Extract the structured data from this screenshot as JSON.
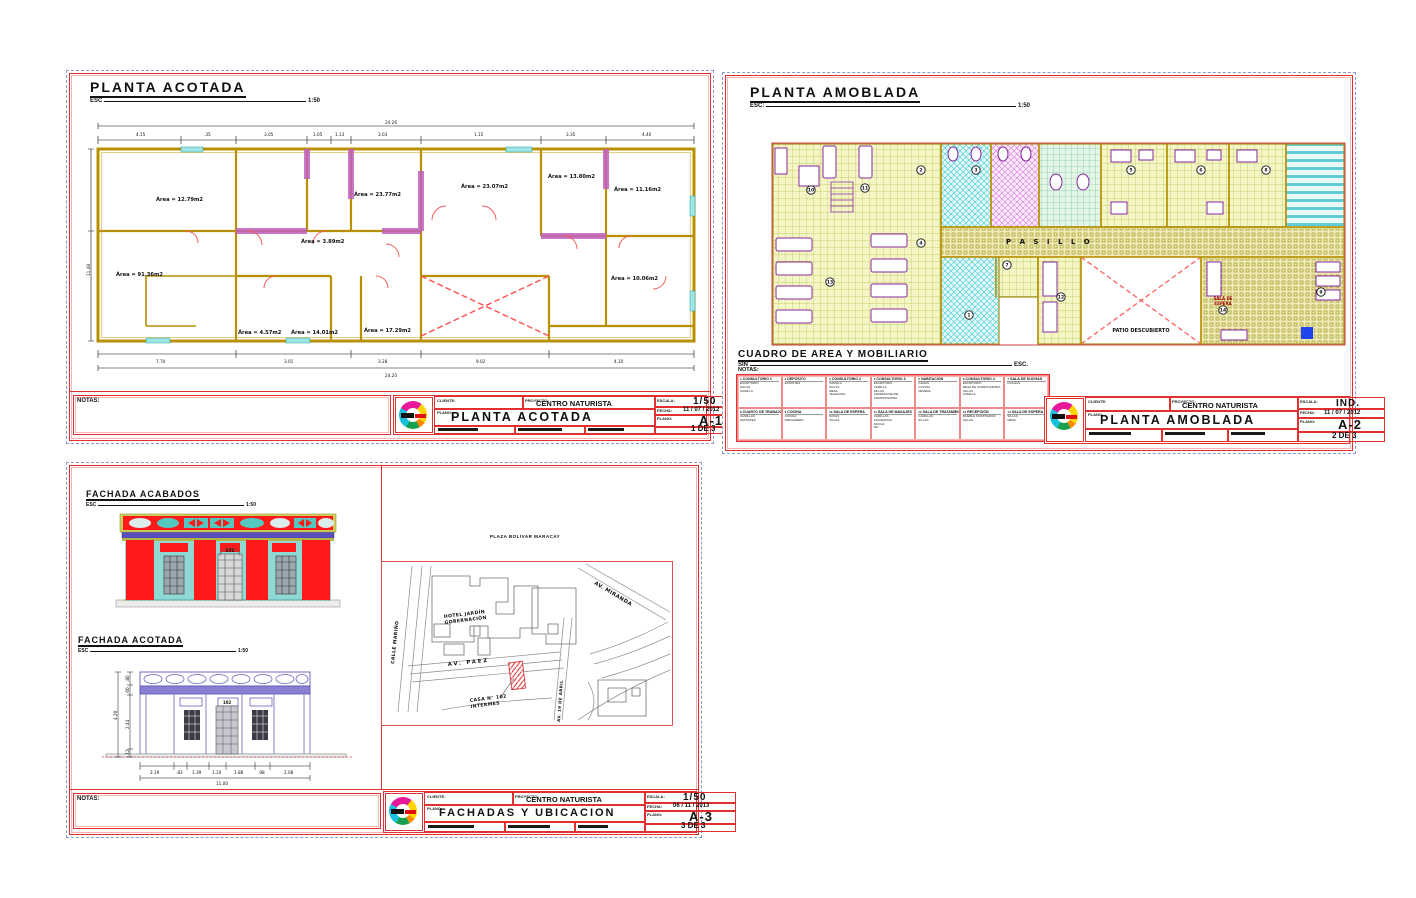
{
  "colors": {
    "sheet_border": "#e03030",
    "pink": "#ffb4b4",
    "dash": "#8d97c9",
    "wall": "#b89000",
    "door": "#f06060",
    "patio_x": "#ff5050",
    "window": "#9fe5e5",
    "hatch_wall": "#c060c0",
    "facade_red": "#ff0000",
    "facade_teal": "#8fd8d4",
    "facade_purple": "#5a4fc0",
    "facade_olive": "#b4b448"
  },
  "sheet1": {
    "title": "PLANTA ACOTADA",
    "esc_label": "ESC",
    "esc_value": "1:50",
    "notas_label": "NOTAS:",
    "areas": [
      "Área = 12.79m2",
      "Área = 23.77m2",
      "Área = 23.07m2",
      "Área = 13.80m2",
      "Área = 11.16m2",
      "Área = 91.36m2",
      "Área = 3.89m2",
      "Área = 4.57m2",
      "Área = 14.01m2",
      "Área = 17.29m2",
      "Área = 10.06m2"
    ],
    "dim_top_total": "24.26",
    "dims_top": [
      "4.15",
      ".35",
      "3.05",
      "1.05",
      "1.13",
      "3.03",
      "1.15",
      "3.35",
      "4.40"
    ],
    "dims_bottom": [
      "7.70",
      "3.01",
      "3.28",
      "9.02",
      "4.10"
    ],
    "dim_bottom_total": "24.20",
    "dim_left_total": "11.48",
    "titleblock": {
      "cliente_label": "CLIENTE:",
      "proyecto_label": "PROYECTO:",
      "proyecto": "CENTRO NATURISTA",
      "plano_label": "PLANO:",
      "plano": "PLANTA ACOTADA",
      "escala_label": "ESCALA:",
      "escala": "1/50",
      "fecha_label": "FECHA:",
      "fecha": "11 / 07 / 2012",
      "codigo_label": "PLANO:",
      "codigo": "A-1",
      "lamina_label": "LAMINA:",
      "lamina": "1 DE 3"
    }
  },
  "sheet2": {
    "title": "PLANTA AMOBLADA",
    "esc_label": "ESC:",
    "esc_value": "1:50",
    "pasillo": "P A S I L L O",
    "patio": "PATIO DESCUBIERTO",
    "sala_line1": "SALA DE",
    "sala_line2": "ESPERA",
    "room_numbers": [
      {
        "n": "1",
        "x": 198,
        "y": 173
      },
      {
        "n": "2",
        "x": 150,
        "y": 28
      },
      {
        "n": "3",
        "x": 205,
        "y": 28
      },
      {
        "n": "4",
        "x": 150,
        "y": 101
      },
      {
        "n": "5",
        "x": 360,
        "y": 28
      },
      {
        "n": "6",
        "x": 430,
        "y": 28
      },
      {
        "n": "7",
        "x": 236,
        "y": 123
      },
      {
        "n": "8",
        "x": 495,
        "y": 28
      },
      {
        "n": "9",
        "x": 550,
        "y": 150
      },
      {
        "n": "10",
        "x": 40,
        "y": 48
      },
      {
        "n": "11",
        "x": 94,
        "y": 46
      },
      {
        "n": "12",
        "x": 290,
        "y": 155
      },
      {
        "n": "13",
        "x": 59,
        "y": 140
      },
      {
        "n": "14",
        "x": 452,
        "y": 168
      }
    ],
    "cuadro": {
      "title": "CUADRO DE AREA Y MOBILIARIO",
      "sin_label": "SIN",
      "esc_label": "ESC.",
      "notas_label": "NOTAS:",
      "cells": [
        {
          "num": "1",
          "name": "CONSULTORIO 1",
          "items": [
            "ESCRITORIO",
            "SILLAS",
            "CAMILLA"
          ]
        },
        {
          "num": "2",
          "name": "DEPOSITO",
          "items": [
            "ESTANTES"
          ]
        },
        {
          "num": "3",
          "name": "CONSULTORIO 2",
          "items": [
            "CAMILLA",
            "SILLAS",
            "MESA",
            "TELEFONO"
          ]
        },
        {
          "num": "4",
          "name": "CONSULTORIO 3",
          "items": [
            "ESCRITORIO",
            "CAMILLA",
            "SILLAS",
            "LAMPARA DE PIE",
            "COMPUTADORA"
          ]
        },
        {
          "num": "5",
          "name": "HABITACIÓN",
          "items": [
            "CAMAS",
            "COCINA",
            "NEVERA"
          ]
        },
        {
          "num": "6",
          "name": "CONSULTORIO 4",
          "items": [
            "ESCRITORIO",
            "MESA DE COMPUTADORA",
            "SILLAS",
            "CAMILLA"
          ]
        },
        {
          "num": "7",
          "name": "SALA DE DUCHAS",
          "items": [
            "DUCHAS"
          ]
        },
        {
          "num": "8",
          "name": "CUARTO DE TRABAJO",
          "items": [
            "CAMILLAS",
            "ESTANTES"
          ]
        },
        {
          "num": "9",
          "name": "COCINA",
          "items": [
            "COCINA",
            "FREGADERO"
          ]
        },
        {
          "num": "10",
          "name": "SALA DE ESPERA",
          "items": [
            "SOFAS",
            "SILLAS"
          ]
        },
        {
          "num": "11",
          "name": "SALA DE MASAJES",
          "items": [
            "CAMILLAS",
            "LAVAMANOS",
            "DUCHA",
            "WC"
          ]
        },
        {
          "num": "12",
          "name": "SALA DE TRATAMIENTO",
          "items": [
            "CAMILLAS",
            "SILLAS"
          ]
        },
        {
          "num": "13",
          "name": "RECEPCIÓN",
          "items": [
            "MUEBLE MOSTRADOR",
            "SILLAS"
          ]
        },
        {
          "num": "14",
          "name": "SALA DE ESPERA",
          "items": [
            "SILLAS",
            "MESA"
          ]
        }
      ]
    },
    "titleblock": {
      "cliente_label": "CLIENTE:",
      "proyecto_label": "PROYECTO:",
      "proyecto": "CENTRO NATURISTA",
      "plano_label": "PLANO:",
      "plano": "PLANTA AMOBLADA",
      "escala_label": "ESCALA:",
      "escala": "IND.",
      "fecha_label": "FECHA:",
      "fecha": "11 / 07 / 2012",
      "codigo_label": "PLANO:",
      "codigo": "A-2",
      "lamina_label": "LAMINA:",
      "lamina": "2 DE 3"
    }
  },
  "sheet3": {
    "fachada1_title": "FACHADA ACABADOS",
    "fachada2_title": "FACHADA ACOTADA",
    "esc_label": "ESC",
    "fachada1_esc": "1:50",
    "fachada2_esc": "1:50",
    "door_number": "102",
    "door_number2": "102",
    "notas_label": "NOTAS:",
    "dims_bottom": [
      "2.19",
      ".83",
      "1.39",
      "1.10",
      "1.88",
      ".98",
      "2.08"
    ],
    "dim_total": "11.00",
    "dims_left": [
      ".80",
      ".60",
      "2.44",
      ".12"
    ],
    "dim_left_total": "4.20",
    "map": {
      "plaza": "PLAZA BOLIVAR MARACAY",
      "hotel_line1": "HOTEL JARDÍN",
      "hotel_line2": "GOBERNACIÓN",
      "street_paez": "AV. PAEZ",
      "street_miranda": "AV. MIRANDA",
      "street_calle": "CALLE MARIÑO",
      "street_abril": "AV. 19 DE ABRIL",
      "casa_line1": "CASA N° 102",
      "casa_line2": "INTERMES"
    },
    "titleblock": {
      "cliente_label": "CLIENTE:",
      "proyecto_label": "PROYECTO:",
      "proyecto": "CENTRO NATURISTA",
      "plano_label": "PLANO:",
      "plano": "FACHADAS Y UBICACION",
      "escala_label": "ESCALA:",
      "escala": "1/50",
      "fecha_label": "FECHA:",
      "fecha": "06 / 11 / 2013",
      "codigo_label": "PLANO:",
      "codigo": "A-3",
      "lamina_label": "LAMINA:",
      "lamina": "3 DE 3"
    }
  }
}
